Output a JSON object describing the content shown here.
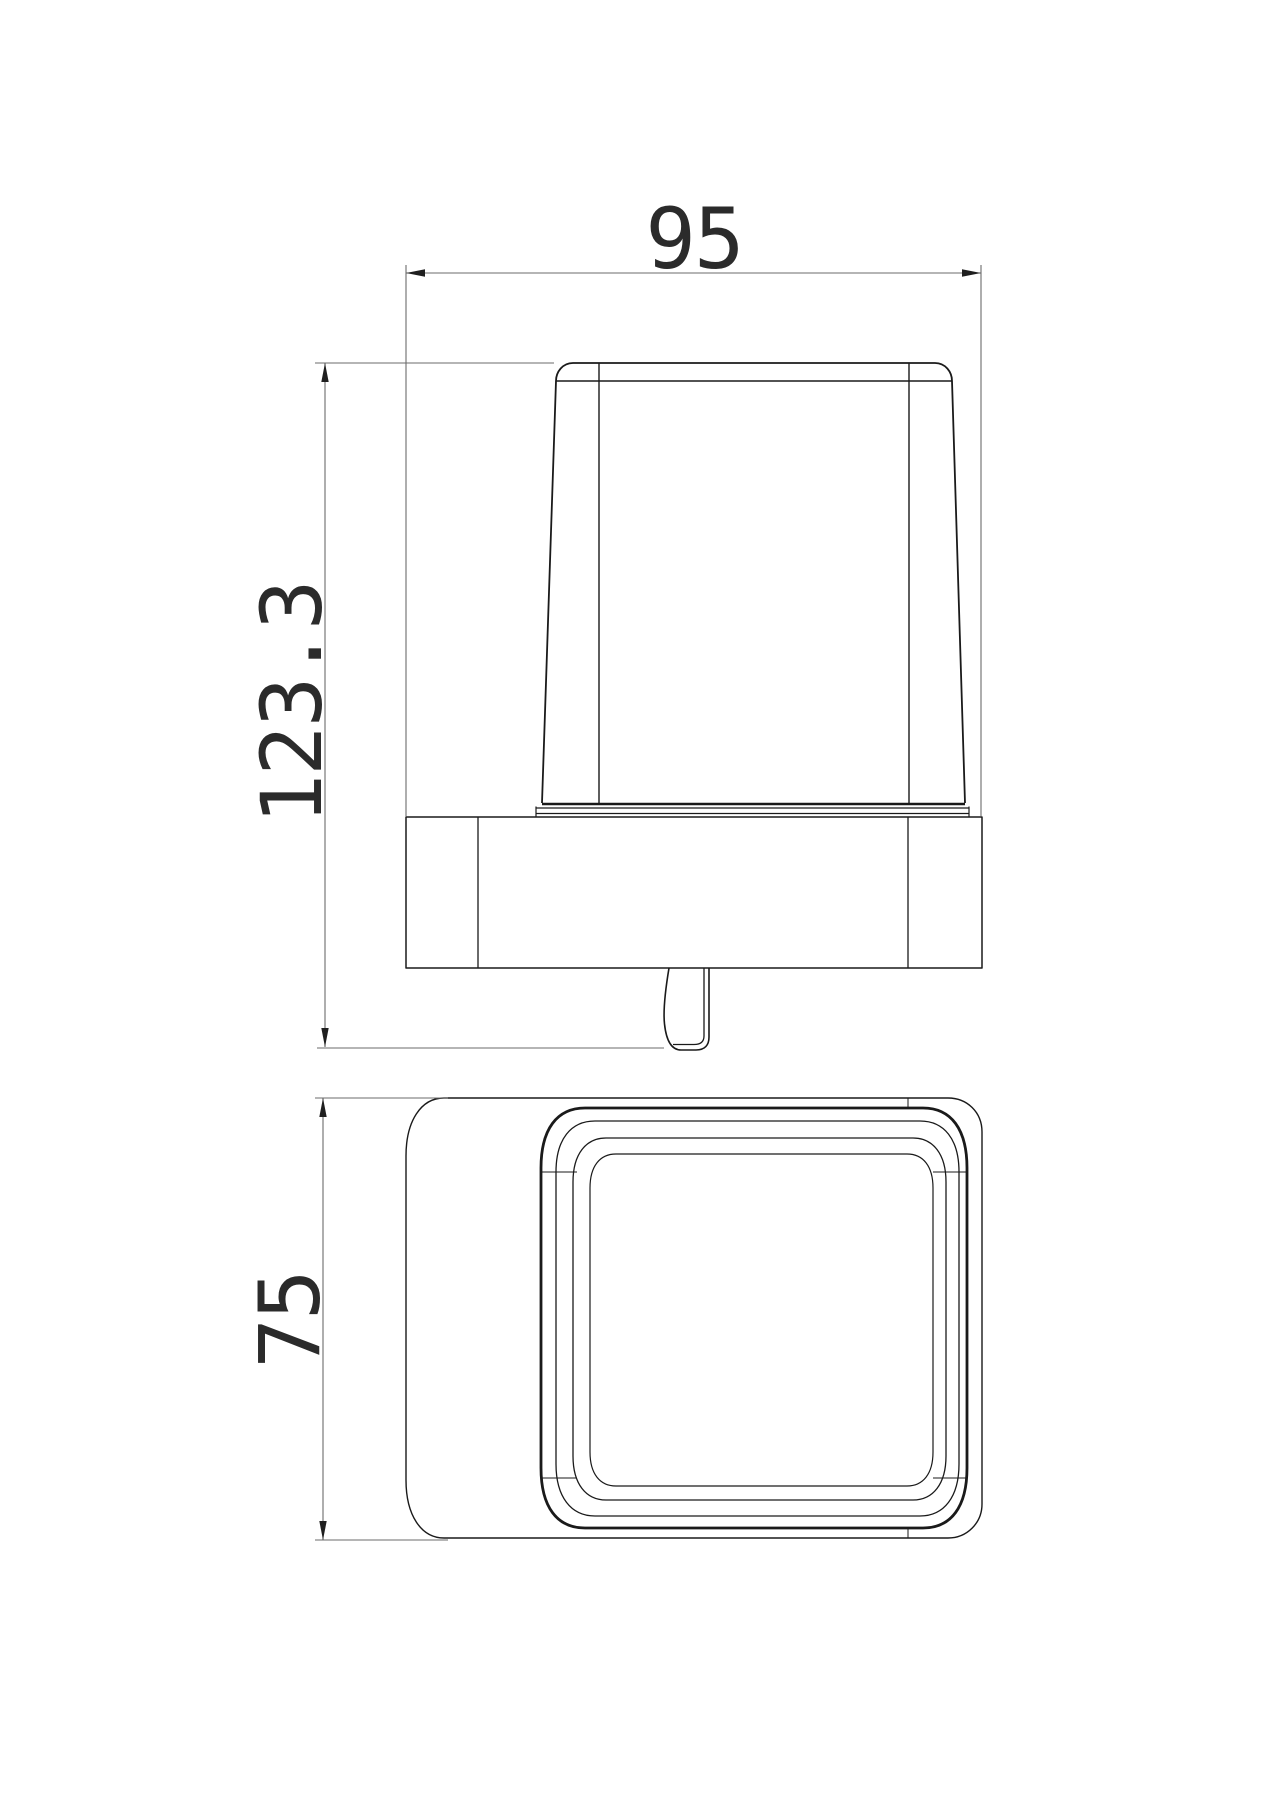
{
  "drawing": {
    "dimensions": {
      "width": "95",
      "height": "123.3",
      "depth": "75"
    },
    "views": {
      "front_view": "front elevation of wall-mounted holder with cup and spout",
      "top_view": "plan view of holder plate with rounded-square cup rim"
    },
    "colors": {
      "geometry_line": "#1a1a1a",
      "dimension_line": "#6b6b6b",
      "text": "#2b2b2b",
      "background": "#ffffff"
    }
  }
}
